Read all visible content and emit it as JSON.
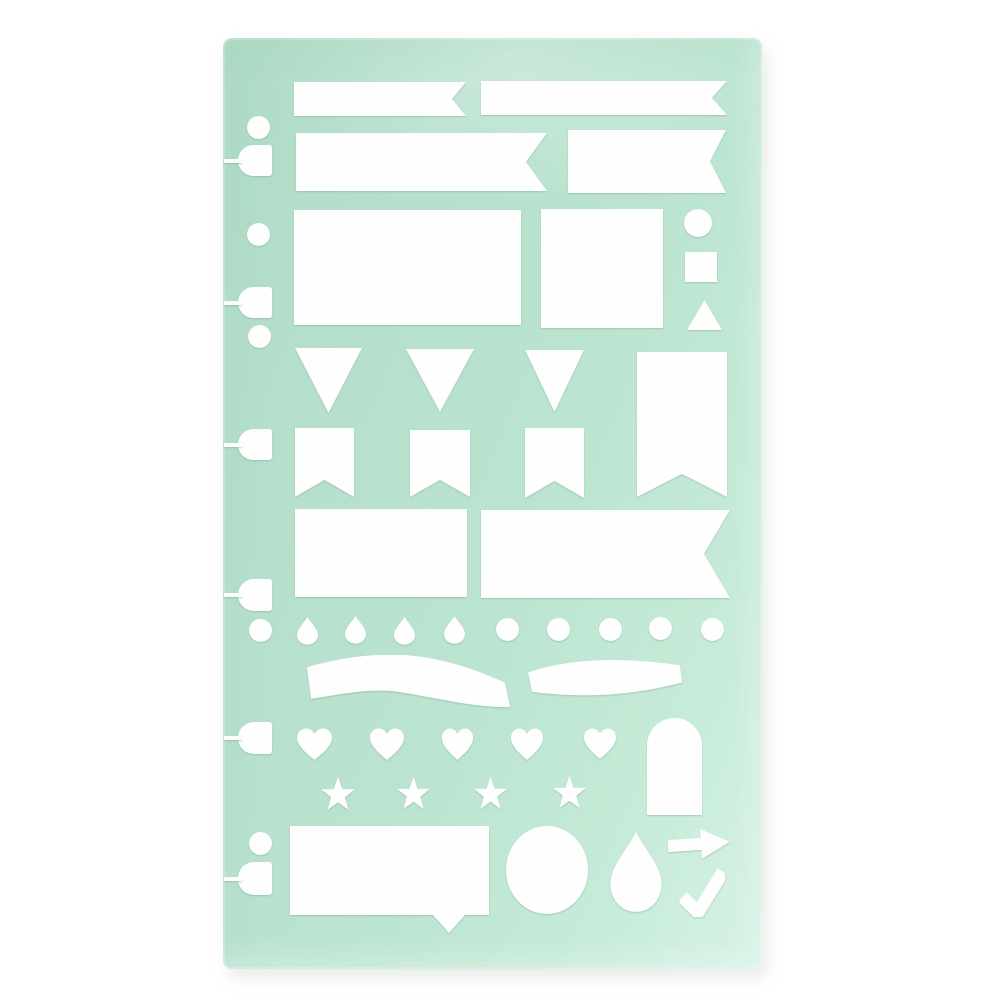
{
  "product": {
    "kind": "planner-stencil-sheet"
  },
  "colors": {
    "page_bg": "#ffffff",
    "stencil_base": "#b7e1cd",
    "stencil_light": "#d7f2e5",
    "stencil_dark": "#afdbc6",
    "cutout": "#fdfefd"
  },
  "stencil": {
    "x": 223,
    "y": 38,
    "width": 539,
    "height": 931,
    "radius": 9
  },
  "shapes": [
    {
      "name": "punch-circle-1",
      "type": "circle",
      "cx": 258,
      "cy": 127,
      "r": 11.5
    },
    {
      "name": "punch-tab-1",
      "type": "tab",
      "x": 238,
      "y": 145,
      "w": 34,
      "h": 31
    },
    {
      "name": "punch-circle-2",
      "type": "circle",
      "cx": 258,
      "cy": 234,
      "r": 11.5
    },
    {
      "name": "punch-tab-2",
      "type": "tab",
      "x": 238,
      "y": 287,
      "w": 34,
      "h": 31
    },
    {
      "name": "punch-circle-3",
      "type": "circle",
      "cx": 259,
      "cy": 336,
      "r": 11.5
    },
    {
      "name": "punch-tab-3",
      "type": "tab",
      "x": 238,
      "y": 429,
      "w": 34,
      "h": 31
    },
    {
      "name": "punch-tab-4",
      "type": "tab",
      "x": 238,
      "y": 579,
      "w": 34,
      "h": 32
    },
    {
      "name": "punch-circle-4",
      "type": "circle",
      "cx": 260,
      "cy": 630,
      "r": 11.5
    },
    {
      "name": "punch-tab-5",
      "type": "tab",
      "x": 238,
      "y": 722,
      "w": 34,
      "h": 32
    },
    {
      "name": "punch-circle-5",
      "type": "circle",
      "cx": 260,
      "cy": 843,
      "r": 11.5
    },
    {
      "name": "punch-tab-6",
      "type": "tab",
      "x": 238,
      "y": 862,
      "w": 34,
      "h": 33
    },
    {
      "name": "cutout-banner-thin-left",
      "type": "banner-right",
      "x": 294,
      "y": 82,
      "w": 172,
      "h": 34,
      "notch": 14
    },
    {
      "name": "cutout-banner-thin-right",
      "type": "banner-right",
      "x": 481,
      "y": 81,
      "w": 246,
      "h": 34,
      "notch": 15
    },
    {
      "name": "cutout-banner-medium-left",
      "type": "banner-right",
      "x": 296,
      "y": 133,
      "w": 251,
      "h": 58,
      "notch": 21
    },
    {
      "name": "cutout-banner-medium-right",
      "type": "banner-right",
      "x": 568,
      "y": 130,
      "w": 158,
      "h": 63,
      "notch": 16
    },
    {
      "name": "cutout-rect-large",
      "type": "rect",
      "x": 294,
      "y": 210,
      "w": 227,
      "h": 115
    },
    {
      "name": "cutout-rect-small",
      "type": "rect",
      "x": 541,
      "y": 209,
      "w": 122,
      "h": 119
    },
    {
      "name": "cutout-circle-small",
      "type": "circle",
      "cx": 698,
      "cy": 223,
      "r": 14
    },
    {
      "name": "cutout-square",
      "type": "rect",
      "x": 685,
      "y": 252,
      "w": 32,
      "h": 30
    },
    {
      "name": "cutout-triangle",
      "type": "triangle-up",
      "x": 687,
      "y": 300,
      "w": 35,
      "h": 30
    },
    {
      "name": "cutout-pennant-1",
      "type": "pennant-down",
      "x": 295,
      "y": 348,
      "w": 67,
      "h": 65
    },
    {
      "name": "cutout-pennant-2",
      "type": "pennant-down",
      "x": 406,
      "y": 349,
      "w": 68,
      "h": 63
    },
    {
      "name": "cutout-pennant-3",
      "type": "pennant-down",
      "x": 525,
      "y": 350,
      "w": 59,
      "h": 62
    },
    {
      "name": "cutout-banner-tall",
      "type": "flag-bottom",
      "x": 637,
      "y": 352,
      "w": 90,
      "h": 145,
      "notch": 23
    },
    {
      "name": "cutout-flag-1",
      "type": "flag-bottom",
      "x": 295,
      "y": 428,
      "w": 59,
      "h": 69,
      "notch": 17
    },
    {
      "name": "cutout-flag-2",
      "type": "flag-bottom",
      "x": 410,
      "y": 430,
      "w": 60,
      "h": 67,
      "notch": 17
    },
    {
      "name": "cutout-flag-3",
      "type": "flag-bottom",
      "x": 525,
      "y": 428,
      "w": 59,
      "h": 70,
      "notch": 17
    },
    {
      "name": "cutout-rect-banner",
      "type": "rect",
      "x": 295,
      "y": 509,
      "w": 172,
      "h": 88
    },
    {
      "name": "cutout-banner-wide",
      "type": "banner-right",
      "x": 481,
      "y": 510,
      "w": 249,
      "h": 88,
      "notch": 26
    },
    {
      "name": "cutout-drop-1",
      "type": "drop",
      "x": 296,
      "y": 616,
      "w": 23,
      "h": 29
    },
    {
      "name": "cutout-drop-2",
      "type": "drop",
      "x": 344,
      "y": 615,
      "w": 23,
      "h": 29
    },
    {
      "name": "cutout-drop-3",
      "type": "drop",
      "x": 393,
      "y": 616,
      "w": 23,
      "h": 29
    },
    {
      "name": "cutout-drop-4",
      "type": "drop",
      "x": 443,
      "y": 615,
      "w": 23,
      "h": 29
    },
    {
      "name": "cutout-dot-1",
      "type": "circle",
      "cx": 507,
      "cy": 629,
      "r": 11.5
    },
    {
      "name": "cutout-dot-2",
      "type": "circle",
      "cx": 558,
      "cy": 629,
      "r": 11.5
    },
    {
      "name": "cutout-dot-3",
      "type": "circle",
      "cx": 610,
      "cy": 629,
      "r": 11.5
    },
    {
      "name": "cutout-dot-4",
      "type": "circle",
      "cx": 660,
      "cy": 628,
      "r": 11.5
    },
    {
      "name": "cutout-dot-5",
      "type": "circle",
      "cx": 712,
      "cy": 629,
      "r": 11.5
    },
    {
      "name": "cutout-ribbon-wave",
      "type": "wave-ribbon",
      "x": 305,
      "y": 655,
      "w": 205,
      "h": 53
    },
    {
      "name": "cutout-ribbon-arc",
      "type": "arc-ribbon",
      "x": 528,
      "y": 655,
      "w": 154,
      "h": 43
    },
    {
      "name": "cutout-heart-1",
      "type": "heart",
      "x": 296,
      "y": 727,
      "w": 37,
      "h": 34
    },
    {
      "name": "cutout-heart-2",
      "type": "heart",
      "x": 369,
      "y": 727,
      "w": 36,
      "h": 34
    },
    {
      "name": "cutout-heart-3",
      "type": "heart",
      "x": 441,
      "y": 727,
      "w": 33,
      "h": 34
    },
    {
      "name": "cutout-heart-4",
      "type": "heart",
      "x": 510,
      "y": 727,
      "w": 34,
      "h": 34
    },
    {
      "name": "cutout-heart-5",
      "type": "heart",
      "x": 583,
      "y": 727,
      "w": 34,
      "h": 33
    },
    {
      "name": "cutout-arch",
      "type": "arch",
      "x": 647,
      "y": 718,
      "w": 55,
      "h": 97
    },
    {
      "name": "cutout-star-1",
      "type": "star",
      "x": 320,
      "y": 776,
      "w": 36,
      "h": 36
    },
    {
      "name": "cutout-star-2",
      "type": "star",
      "x": 396,
      "y": 776,
      "w": 35,
      "h": 35
    },
    {
      "name": "cutout-star-3",
      "type": "star",
      "x": 473,
      "y": 776,
      "w": 35,
      "h": 35
    },
    {
      "name": "cutout-star-4",
      "type": "star",
      "x": 552,
      "y": 775,
      "w": 35,
      "h": 35
    },
    {
      "name": "cutout-speech-bubble",
      "type": "speech-bubble",
      "x": 290,
      "y": 826,
      "w": 199,
      "h": 107,
      "body_h": 89,
      "tail_l": 143,
      "tail_r": 175,
      "tail_apex": 159
    },
    {
      "name": "cutout-circle-large",
      "type": "ellipse",
      "cx": 547,
      "cy": 870,
      "rx": 41,
      "ry": 44
    },
    {
      "name": "cutout-teardrop-large",
      "type": "drop",
      "x": 608,
      "y": 829,
      "w": 56,
      "h": 84
    },
    {
      "name": "cutout-arrow",
      "type": "arrow-right",
      "x": 668,
      "y": 829,
      "w": 62,
      "h": 31,
      "rotate": -4
    },
    {
      "name": "cutout-checkmark",
      "type": "check",
      "x": 679,
      "y": 869,
      "w": 47,
      "h": 48,
      "rotate": -3
    }
  ]
}
